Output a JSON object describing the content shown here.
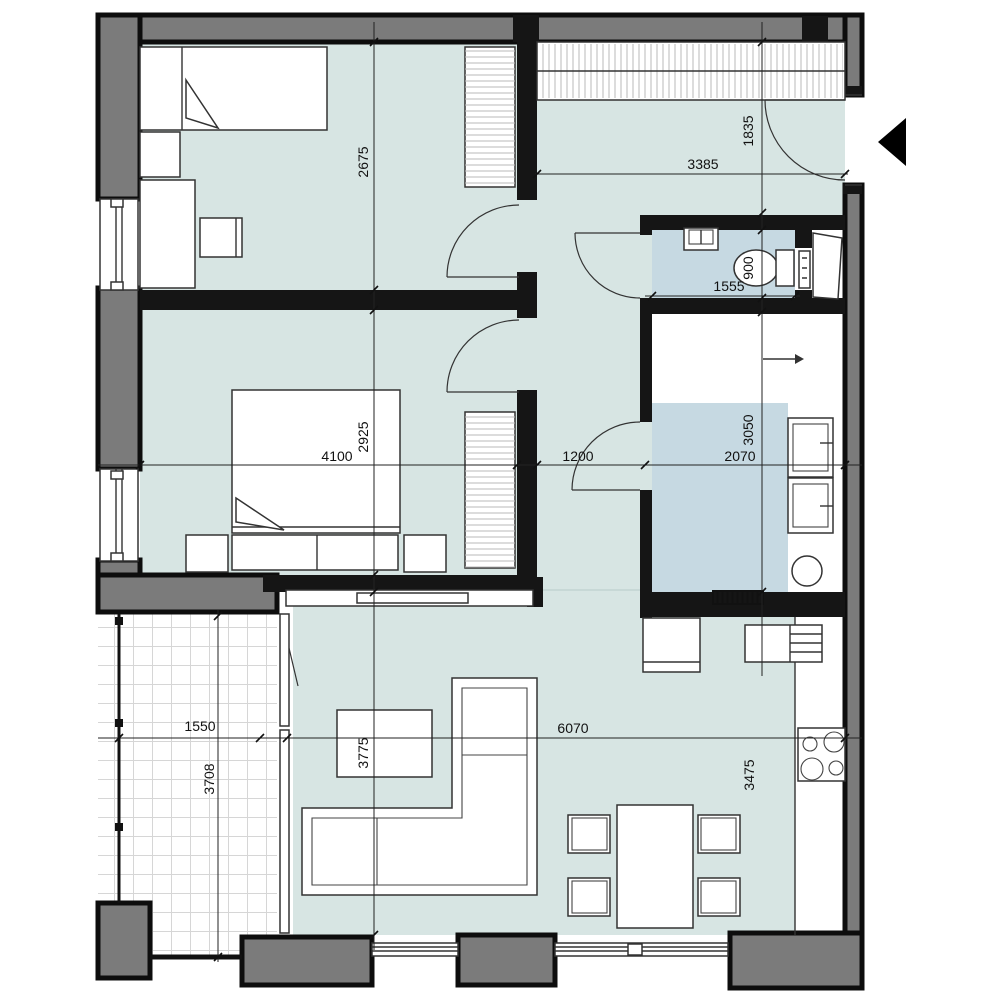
{
  "colors": {
    "floor_main": "#d7e5e3",
    "floor_wet": "#c6d9e2",
    "exterior_wall_fill": "#7b7b7b",
    "interior_wall_fill": "#151515",
    "dimension_line": "#222222",
    "entrance_arrow": "#000000"
  },
  "dimensions": {
    "bedroom1_height": "2675",
    "entry_hall_width": "3385",
    "entry_hall_height": "1835",
    "wc_width": "1555",
    "wc_depth": "900",
    "bedroom2_width": "4100",
    "bedroom2_height": "2925",
    "hallway_width": "1200",
    "bathroom_width": "2070",
    "bathroom_height": "3050",
    "balcony_width": "1550",
    "balcony_length": "3708",
    "living_depth_sofa": "3775",
    "living_width": "6070",
    "living_depth_kitchen": "3475"
  },
  "icons": {
    "entrance_arrow": "entrance-direction-triangle",
    "shower_slope_arrow": "slope-direction-arrow"
  }
}
